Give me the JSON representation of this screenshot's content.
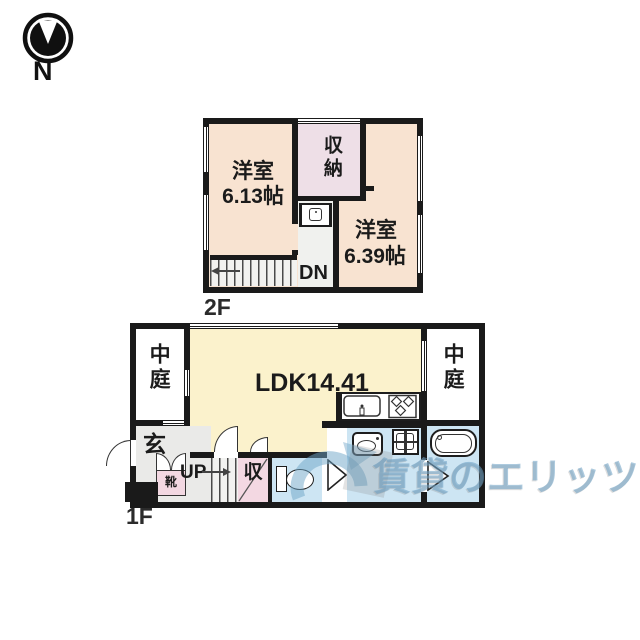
{
  "compass": {
    "north_label": "N"
  },
  "floor2": {
    "label": "2F",
    "room_left_name": "洋室",
    "room_left_size": "6.13帖",
    "closet": "収納",
    "room_right_name": "洋室",
    "room_right_size": "6.39帖",
    "stairs_down": "DN"
  },
  "floor1": {
    "label": "1F",
    "courtyard_left": "中庭",
    "ldk": "LDK14.41",
    "courtyard_right": "中庭",
    "entrance": "玄",
    "shoe_cabinet": "靴",
    "stairs_up": "UP",
    "storage": "収"
  },
  "watermark": {
    "text": "賃貸のエリッツ"
  },
  "colors": {
    "wall": "#1a1a1a",
    "room-peach": "#f8e3d1",
    "closet-pink": "#eedfe7",
    "ldk-yellow": "#fbf2cc",
    "storage-pink": "#f3d8e2",
    "sanitary-blue": "#cde5f3",
    "hall-gray": "#f0f1ee",
    "entrance-gray": "#eaeae8",
    "watermark-blue": "#6f9fc3"
  }
}
